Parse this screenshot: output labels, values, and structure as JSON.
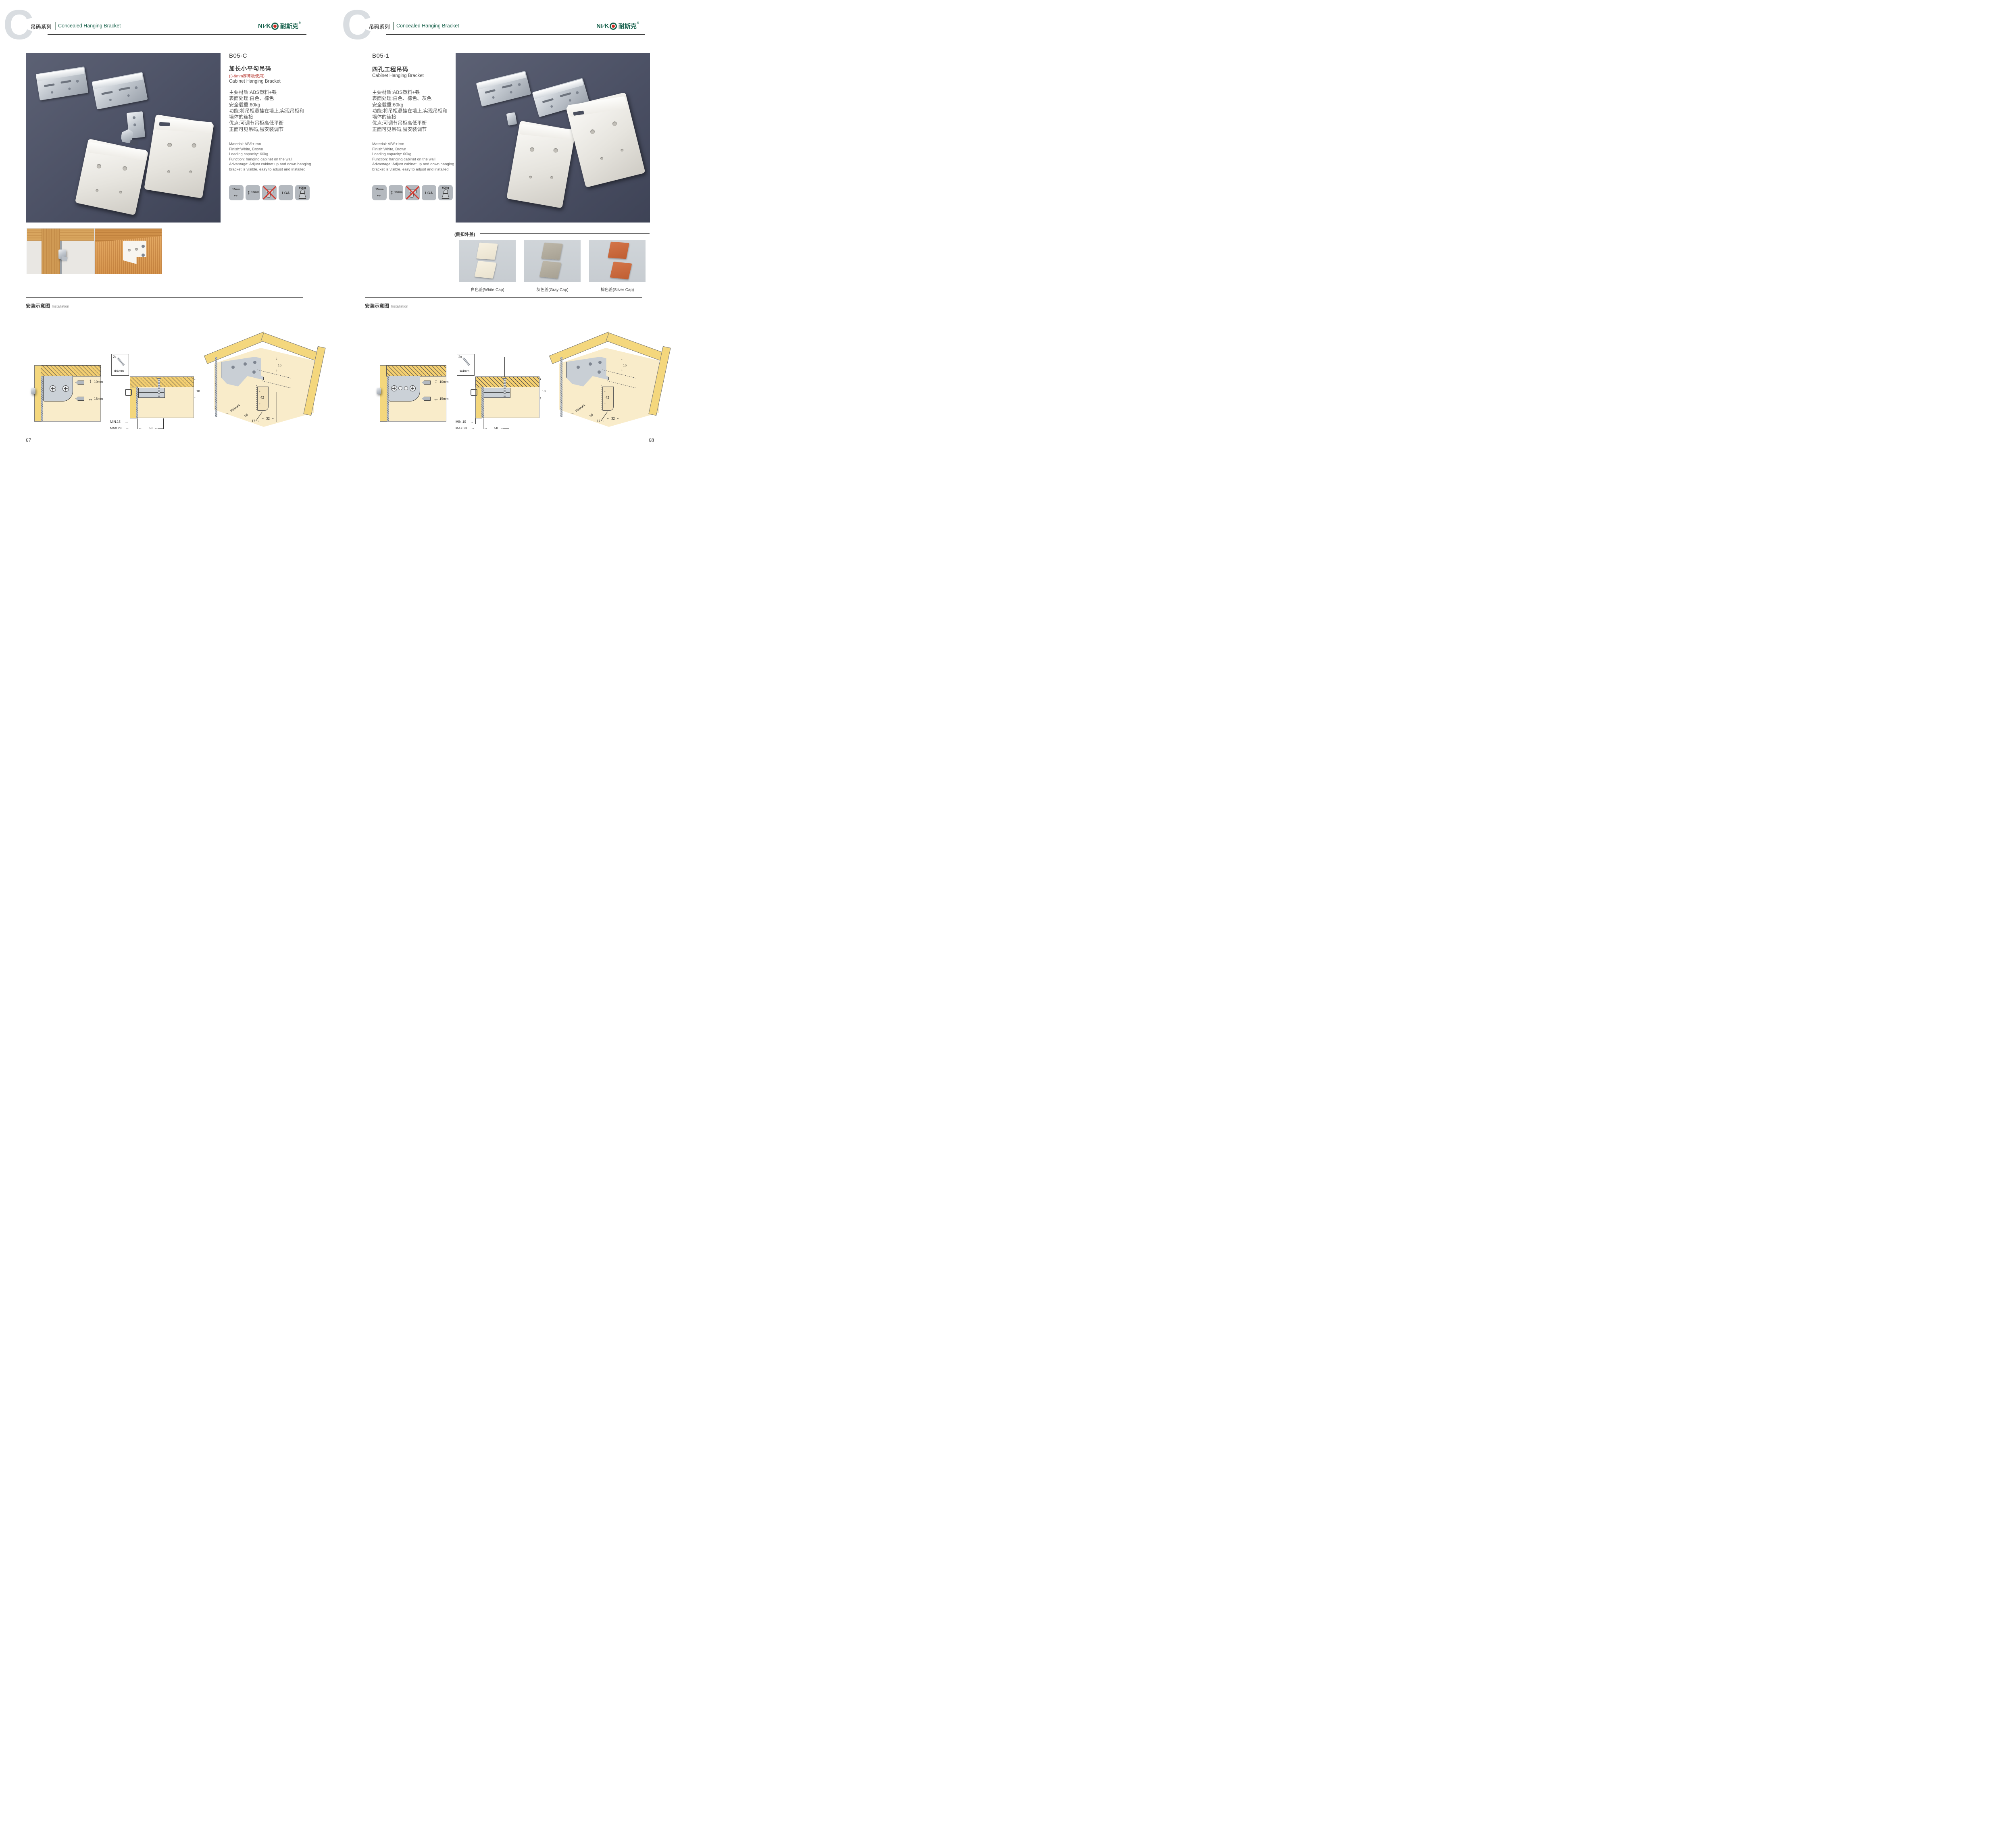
{
  "logo": {
    "latin_left": "NI",
    "slash": "∕",
    "latin_right": "K",
    "cn": "耐斯克",
    "reg": "®"
  },
  "pages": [
    {
      "number": "67",
      "header": {
        "watermark": "C",
        "series_cn": "吊码系列",
        "series_en": "Concealed Hanging Bracket"
      },
      "product": {
        "code": "B05-C",
        "name_cn": "加长小平勾吊码",
        "note": "(3-9mm厚背板使用)",
        "name_en": "Cabinet Hanging Bracket",
        "specs_cn": "主要材质:ABS塑料+铁\n表面处理:白色、棕色\n安全载重:60kg\n功能:将吊柜悬挂在墙上,实现吊柜和\n墙体的连接\n优点:可调节吊柜高低平衡\n正面可见吊码,易安装调节",
        "specs_en": "Material: ABS+Iron\nFinish:White, Brown\nLoading capacity: 60kg\nFunction: hanging cabinet on the wall\nAdvantage: Adjust cabinet up and down hanging\nbracket is visible, easy to adjust and installed"
      },
      "icons": {
        "width_label": "15mm",
        "height_label": "10mm",
        "cert_label": "LGA",
        "load_label": "60Kg"
      },
      "installation": {
        "title_cn": "安装示意图",
        "title_en": "Installation",
        "d1_top": "10mm",
        "d1_bottom": "15mm",
        "d2_qty": "2x",
        "d2_dia": "Φ4mm",
        "d2_height": "18",
        "d2_min": "MIN.15",
        "d2_max": "MAX.28",
        "d2_depth": "58",
        "d3_top": "16",
        "d3_mid": "42",
        "d3_radius": "RMAX4",
        "d3_b1": "16",
        "d3_b2": "17",
        "d3_b3": "32"
      }
    },
    {
      "number": "68",
      "header": {
        "watermark": "C",
        "series_cn": "吊码系列",
        "series_en": "Concealed Hanging Bracket"
      },
      "product": {
        "code": "B05-1",
        "name_cn": "四孔工程吊码",
        "note": "",
        "name_en": "Cabinet Hanging Bracket",
        "specs_cn": "主要材质:ABS塑料+铁\n表面处理:白色、棕色、灰色\n安全载重:60kg\n功能:将吊柜悬挂在墙上,实现吊柜和\n墙体的连接\n优点:可调节吊柜高低平衡\n正面可见吊码,易安装调节",
        "specs_en": "Material: ABS+Iron\nFinish:White, Brown\nLoading capacity: 60kg\nFunction: hanging cabinet on the wall\nAdvantage: Adjust cabinet up and down hanging\nbracket is visible, easy to adjust and installed"
      },
      "icons": {
        "width_label": "15mm",
        "height_label": "10mm",
        "cert_label": "LGA",
        "load_label": "60Kg"
      },
      "caps": {
        "section_label": "(侧扣外盖)",
        "items": [
          {
            "label": "白色盖(White Cap)",
            "hex": "#efe9d7"
          },
          {
            "label": "灰色盖(Gray Cap)",
            "hex": "#b2ab9d"
          },
          {
            "label": "棕色盖(Silver Cap)",
            "hex": "#c96a3c"
          }
        ]
      },
      "installation": {
        "title_cn": "安装示意图",
        "title_en": "Installation",
        "d1_top": "10mm",
        "d1_bottom": "15mm",
        "d2_qty": "2x",
        "d2_dia": "Φ4mm",
        "d2_height": "18",
        "d2_min": "MIN.10",
        "d2_max": "MAX.23",
        "d2_depth": "58",
        "d3_top": "16",
        "d3_mid": "42",
        "d3_radius": "RMAX4",
        "d3_b1": "16",
        "d3_b2": "17",
        "d3_b3": "32"
      }
    }
  ]
}
